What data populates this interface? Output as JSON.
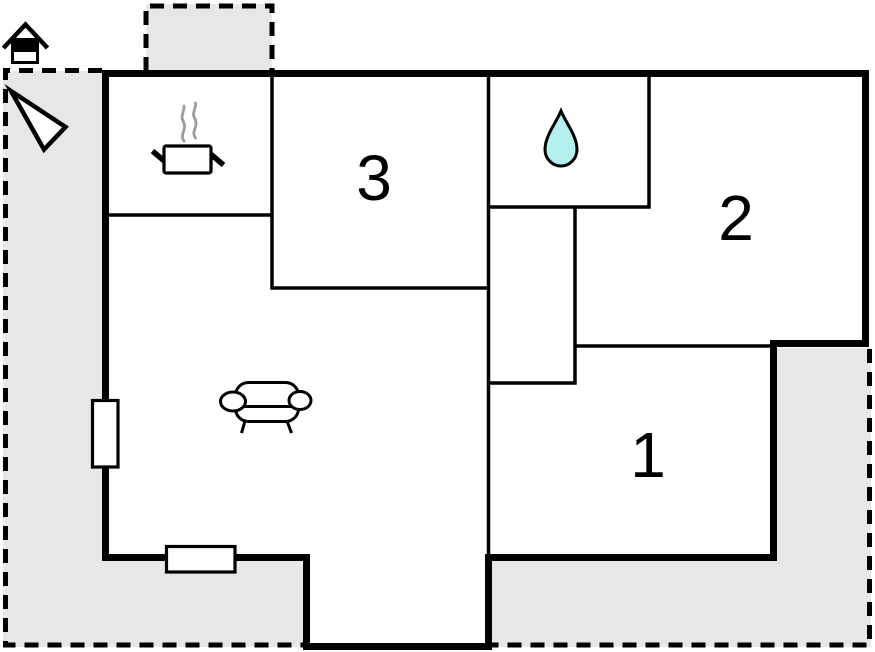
{
  "floorplan": {
    "room_labels": {
      "room1": "1",
      "room2": "2",
      "room3": "3"
    },
    "icons": {
      "house": "house-icon",
      "north_arrow": "north-arrow-icon",
      "cooking_pot": "cooking-pot-icon",
      "steam": "steam-icon",
      "water_drop": "water-drop-icon",
      "sofa": "sofa-icon"
    },
    "colors": {
      "terrace": "#e7e7e7",
      "walls": "#000000",
      "room_fill": "#ffffff",
      "water_drop": "#b3f0ee",
      "steam": "#9b9b9b"
    }
  }
}
